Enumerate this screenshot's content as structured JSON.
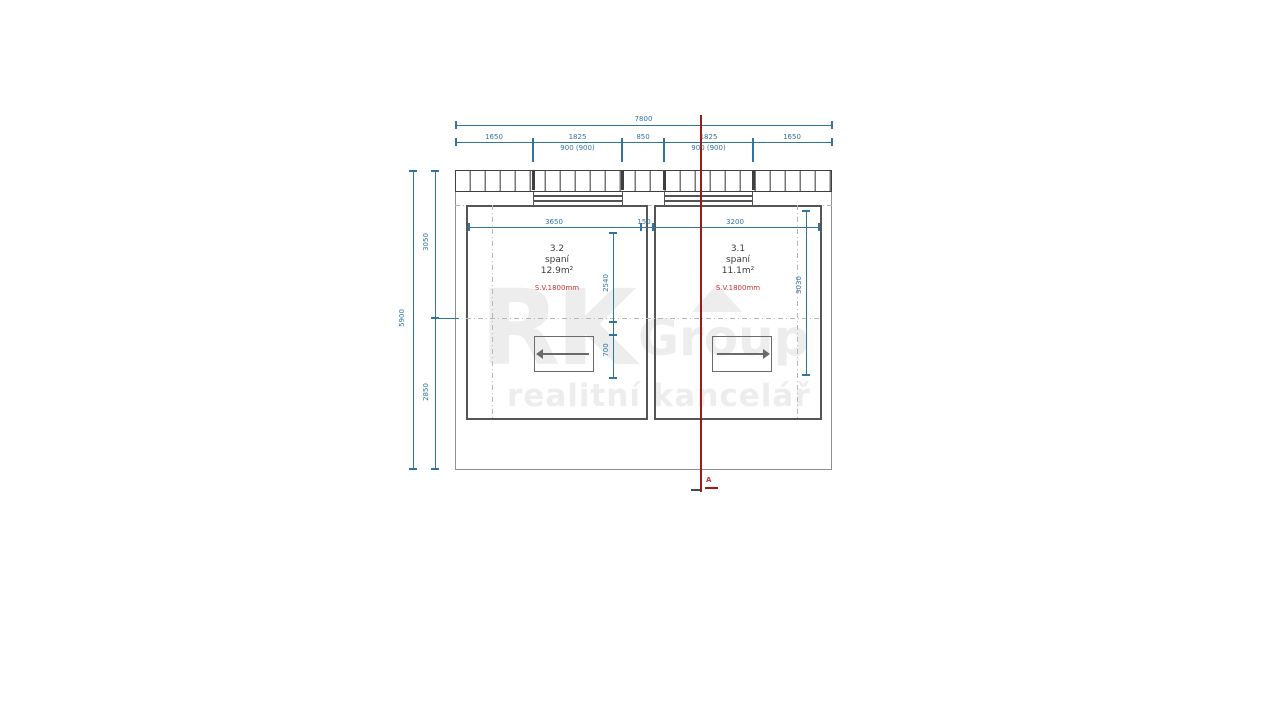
{
  "watermark": {
    "rk": "RK",
    "group": "Group",
    "tagline": "realitní kancelář"
  },
  "rooms": [
    {
      "number": "3.2",
      "use": "spaní",
      "area": "12.9m²",
      "clearance": "S.V.1800mm"
    },
    {
      "number": "3.1",
      "use": "spaní",
      "area": "11.1m²",
      "clearance": "S.V.1800mm"
    }
  ],
  "dims": {
    "top_total": "7800",
    "top_segments": [
      "1650",
      "1825",
      "850",
      "1825",
      "1650"
    ],
    "window_left": "900 (900)",
    "window_right": "900 (900)",
    "left_total": "5900",
    "left_top": "3050",
    "left_bottom": "2850",
    "room_left_width": "3650",
    "partition": "150",
    "room_right_width": "3200",
    "mid_upper": "2540",
    "mid_lower": "700",
    "right_depth": "3030"
  },
  "section": {
    "label": "A"
  },
  "colors": {
    "dimension": "#33749f",
    "wall": "#555555",
    "outline": "#8f8f8f",
    "dashdot": "#b8b8b8",
    "red_line": "#9e1a1a",
    "red_text": "#d03030",
    "watermark": "#ededed"
  }
}
